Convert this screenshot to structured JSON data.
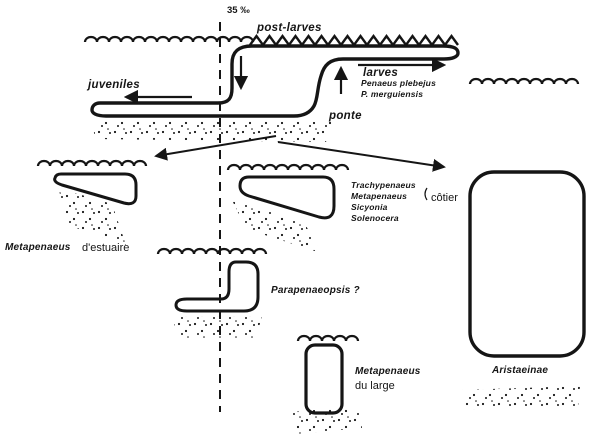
{
  "figure": {
    "salinity": "35 ‰",
    "post_larves": "post-larves",
    "juveniles": "juveniles",
    "larves": "larves",
    "species": [
      "Penaeus plebejus",
      "P. merguiensis"
    ],
    "ponte": "ponte"
  },
  "cycles": {
    "estuary": {
      "genus": "Metapenaeus",
      "qualifier": "d'estuaire"
    },
    "coastal": {
      "genera": [
        "Trachypenaeus",
        "Metapenaeus",
        "Sicyonia",
        "Solenocera"
      ],
      "label": "côtier"
    },
    "shallow": {
      "label": "Parapenaeopsis ?"
    },
    "offshore": {
      "genus": "Metapenaeus",
      "qualifier": "du large"
    },
    "deep_sea": {
      "label": "Aristaeinae"
    }
  },
  "colors": {
    "ink": "#151515",
    "paper": "#ffffff"
  }
}
